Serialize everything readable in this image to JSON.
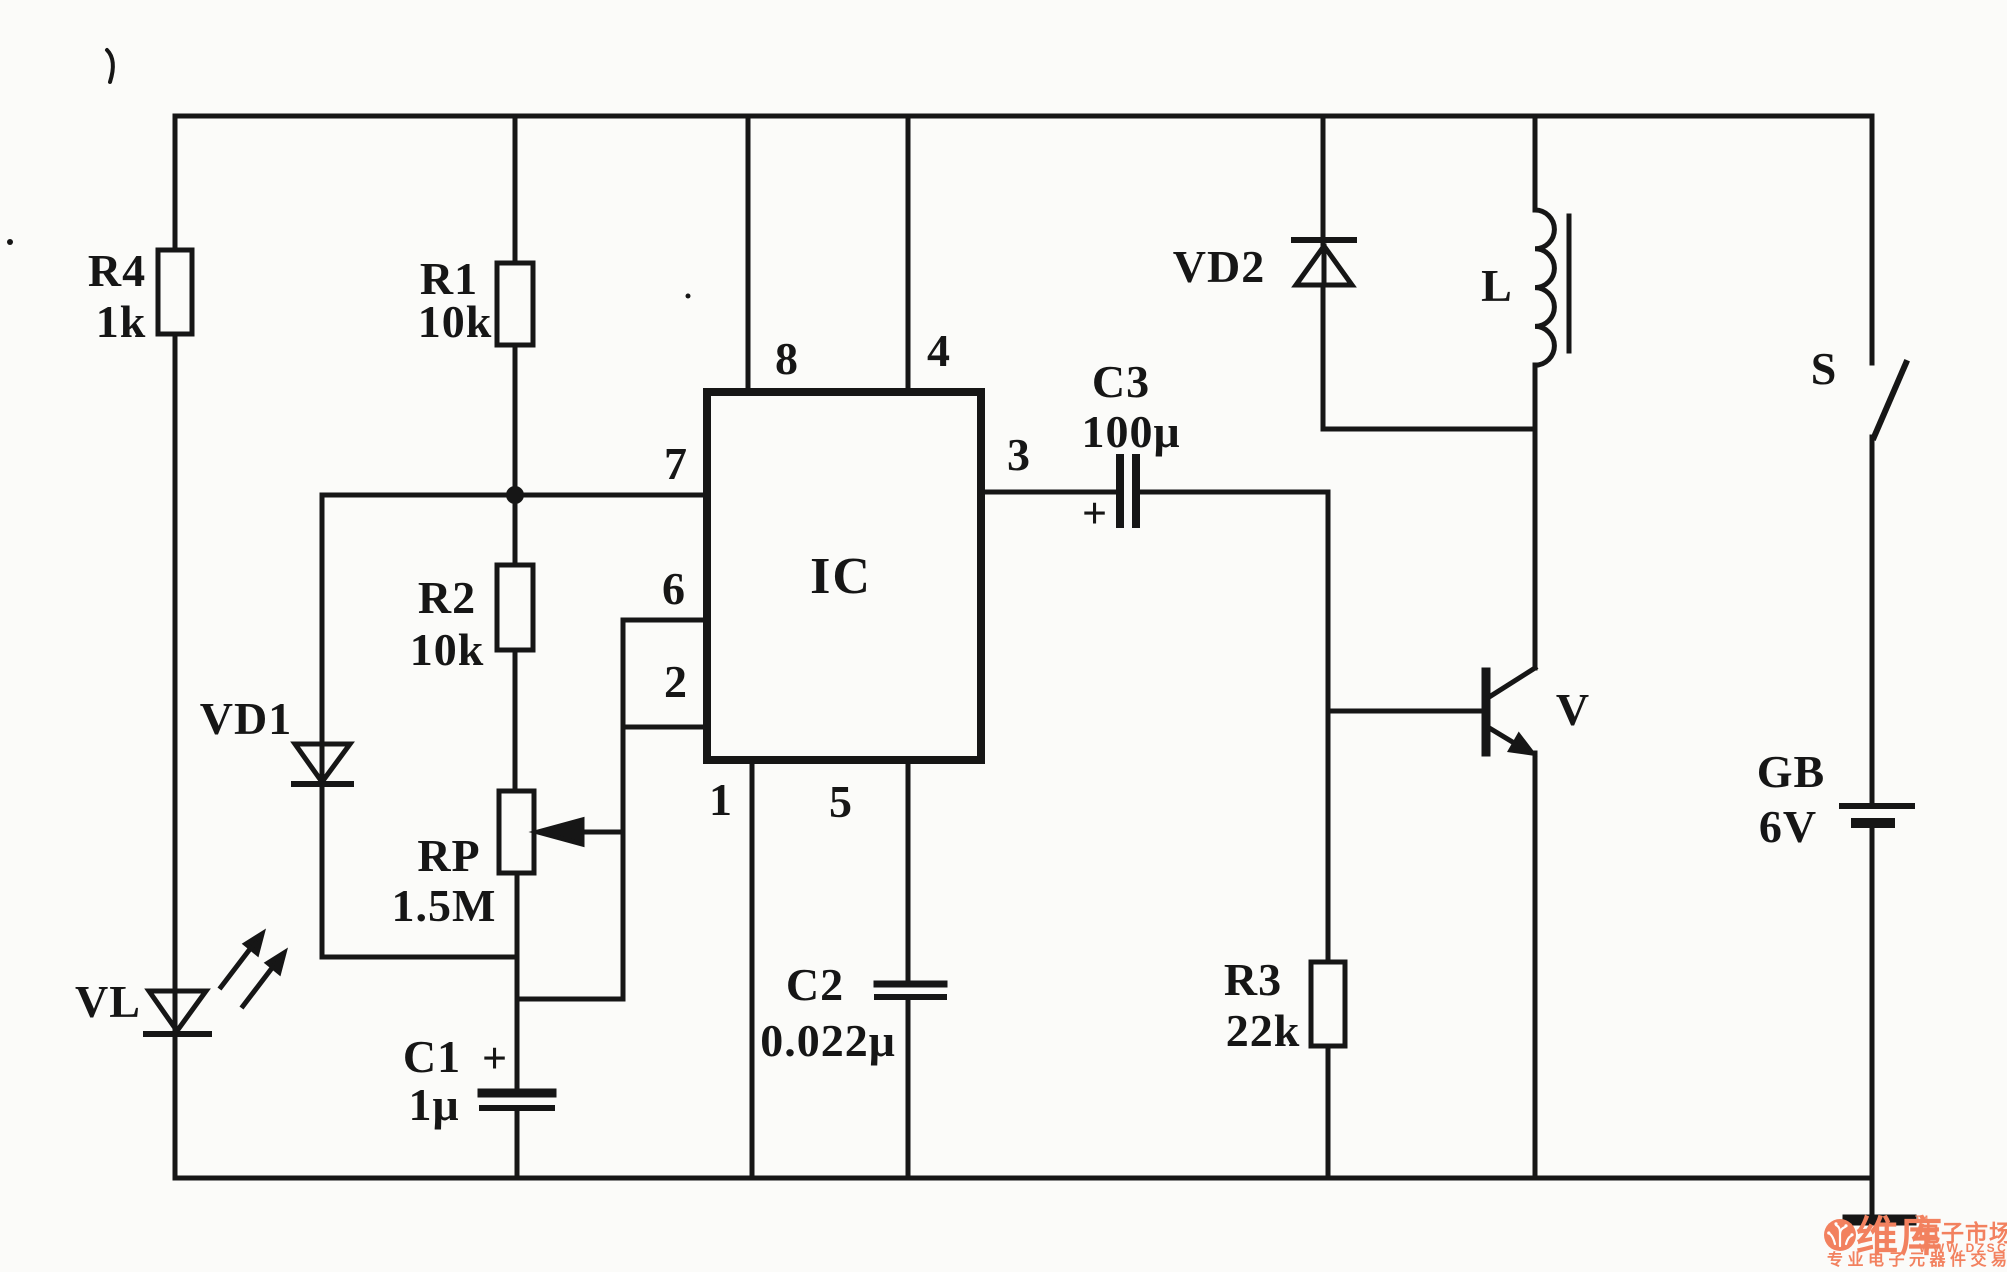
{
  "title": "555 IC light-controlled relay circuit schematic",
  "ic": {
    "label": "IC",
    "pins": {
      "p1": "1",
      "p2": "2",
      "p3": "3",
      "p4": "4",
      "p5": "5",
      "p6": "6",
      "p7": "7",
      "p8": "8"
    }
  },
  "components": {
    "r1": {
      "ref": "R1",
      "value": "10k"
    },
    "r2": {
      "ref": "R2",
      "value": "10k"
    },
    "r3": {
      "ref": "R3",
      "value": "22k"
    },
    "r4": {
      "ref": "R4",
      "value": "1k"
    },
    "rp": {
      "ref": "RP",
      "value": "1.5M"
    },
    "c1": {
      "ref": "C1",
      "value": "1μ",
      "polarity": "+"
    },
    "c2": {
      "ref": "C2",
      "value": "0.022μ"
    },
    "c3": {
      "ref": "C3",
      "value": "100μ",
      "polarity": "+"
    },
    "vd1": {
      "ref": "VD1"
    },
    "vd2": {
      "ref": "VD2"
    },
    "vl": {
      "ref": "VL"
    },
    "l": {
      "ref": "L"
    },
    "v": {
      "ref": "V"
    },
    "s": {
      "ref": "S"
    },
    "gb": {
      "ref": "GB",
      "value": "6V"
    }
  },
  "watermark": {
    "brand": "维库",
    "tm": "TM",
    "brand_suffix": "电子市场网",
    "url": "WWW.DZSC.COM",
    "tagline": "专业电子元器件交易网站",
    "color": "#f2815f"
  },
  "colors": {
    "ink": "#161616",
    "paper": "#fbfbf9"
  }
}
